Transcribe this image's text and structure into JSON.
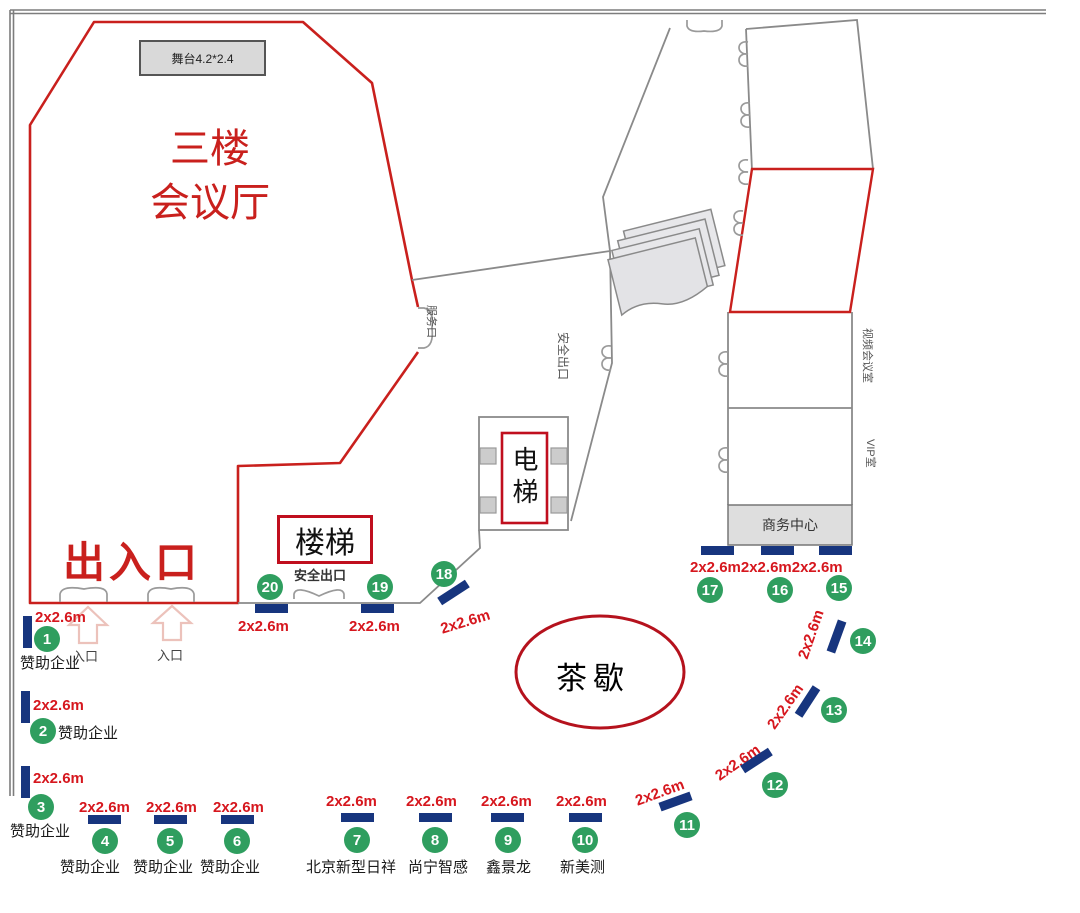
{
  "colors": {
    "accent_red": "#c9201d",
    "booth_green": "#2f9e5f",
    "bar_blue": "#17357e",
    "size_red": "#d6171e"
  },
  "hall": {
    "name_line1": "三楼",
    "name_line2": "会议厅",
    "stage_label": "舞台4.2*2.4",
    "exit_label": "出入口",
    "entrance_label_1": "入口",
    "entrance_label_2": "入口",
    "service_door_label": "服务口"
  },
  "stairwell": {
    "stairs_label": "楼梯",
    "safety_exit_label": "安全出口"
  },
  "corridor": {
    "safety_exit_label": "安全出口"
  },
  "elevator": {
    "label": "电梯"
  },
  "tea_break": {
    "label": "茶歇"
  },
  "right_wing": {
    "meeting_room_label": "视频会议室",
    "vip_room_label": "VIP室",
    "business_center_label": "商务中心"
  },
  "booths": [
    {
      "no": "1",
      "size": "2x2.6m",
      "company": "赞助企业"
    },
    {
      "no": "2",
      "size": "2x2.6m",
      "company": "赞助企业"
    },
    {
      "no": "3",
      "size": "2x2.6m",
      "company": "赞助企业"
    },
    {
      "no": "4",
      "size": "2x2.6m",
      "company": "赞助企业"
    },
    {
      "no": "5",
      "size": "2x2.6m",
      "company": "赞助企业"
    },
    {
      "no": "6",
      "size": "2x2.6m",
      "company": "赞助企业"
    },
    {
      "no": "7",
      "size": "2x2.6m",
      "company": "北京新型日祥"
    },
    {
      "no": "8",
      "size": "2x2.6m",
      "company": "尚宁智感"
    },
    {
      "no": "9",
      "size": "2x2.6m",
      "company": "鑫景龙"
    },
    {
      "no": "10",
      "size": "2x2.6m",
      "company": "新美测"
    },
    {
      "no": "11",
      "size": "2x2.6m",
      "company": ""
    },
    {
      "no": "12",
      "size": "2x2.6m",
      "company": ""
    },
    {
      "no": "13",
      "size": "2x2.6m",
      "company": ""
    },
    {
      "no": "14",
      "size": "2x2.6m",
      "company": ""
    },
    {
      "no": "15",
      "size": "2x2.6m",
      "company": ""
    },
    {
      "no": "16",
      "size": "2x2.6m",
      "company": ""
    },
    {
      "no": "17",
      "size": "2x2.6m",
      "company": ""
    },
    {
      "no": "18",
      "size": "2x2.6m",
      "company": ""
    },
    {
      "no": "19",
      "size": "2x2.6m",
      "company": ""
    },
    {
      "no": "20",
      "size": "2x2.6m",
      "company": ""
    }
  ]
}
